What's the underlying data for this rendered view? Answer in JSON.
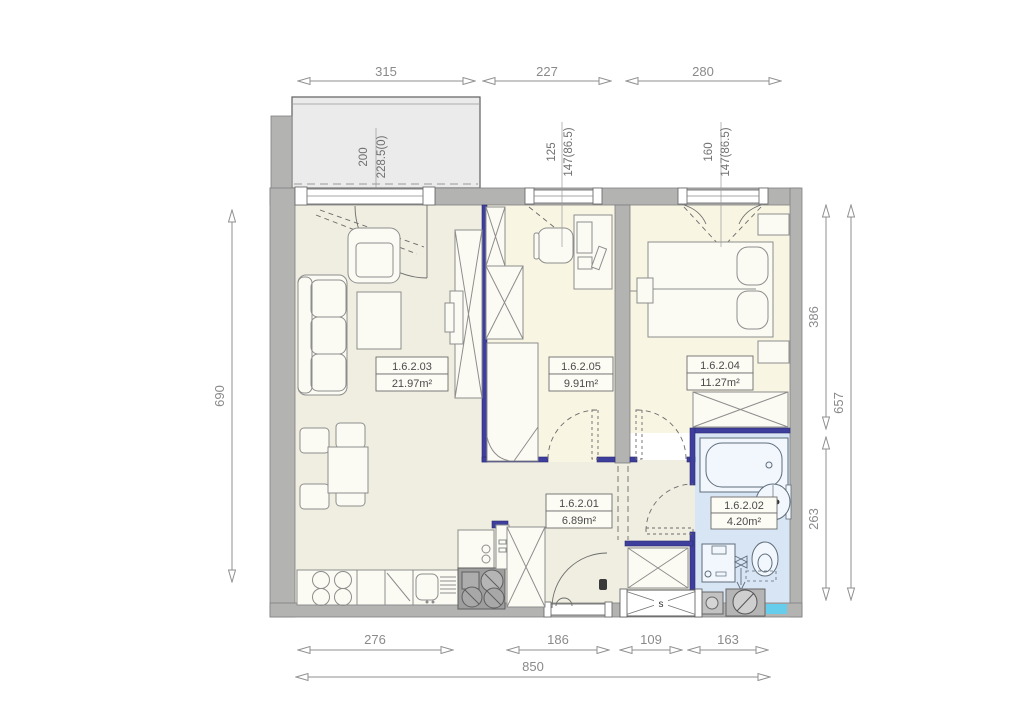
{
  "dims": {
    "top": [
      "315",
      "227",
      "280"
    ],
    "bottom": [
      "276",
      "186",
      "109",
      "163"
    ],
    "bottom_total": "850",
    "left": "690",
    "right_top": "386",
    "right_bottom": "263",
    "right_total": "657"
  },
  "windows": {
    "balcony_door": {
      "w": "200",
      "h": "228.5(0)"
    },
    "study_window": {
      "w": "125",
      "h": "147(86.5)"
    },
    "bedroom_window": {
      "w": "160",
      "h": "147(86.5)"
    }
  },
  "rooms": {
    "hall": {
      "id": "1.6.2.01",
      "area": "6.89m²"
    },
    "bath": {
      "id": "1.6.2.02",
      "area": "4.20m²"
    },
    "living": {
      "id": "1.6.2.03",
      "area": "21.97m²"
    },
    "bedroom": {
      "id": "1.6.2.04",
      "area": "11.27m²"
    },
    "study": {
      "id": "1.6.2.05",
      "area": "9.91m²"
    }
  },
  "shaft": {
    "label": "s"
  },
  "colors": {
    "wall_gray": "#b3b3b2",
    "partition_blue": "#3e3e9d",
    "floor_living": "#efeee1",
    "floor_bedroom": "#f8f5e3",
    "floor_bath": "#d8e5f4",
    "balcony_gray": "#ebebeb",
    "dimension_gray": "#8a8a8a",
    "accent_cyan": "#66cdec"
  }
}
